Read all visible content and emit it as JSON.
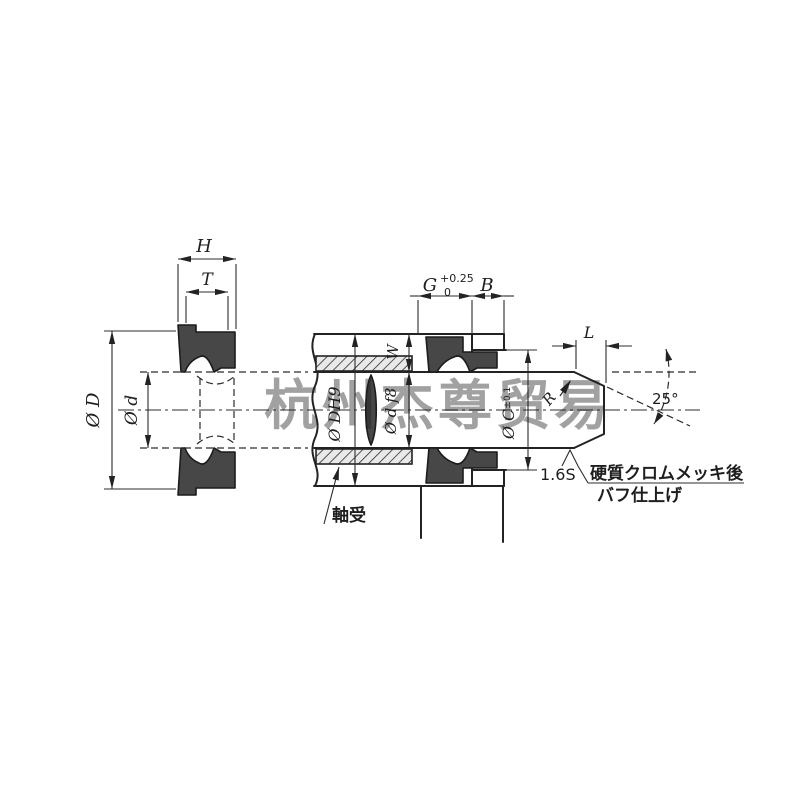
{
  "colors": {
    "background": "#ffffff",
    "line": "#232323",
    "seal_fill": "#474747",
    "watermark": "#bfbfbf"
  },
  "watermark": {
    "text": "杭州杰尊贸易"
  },
  "left_view": {
    "width_label": "H",
    "inner_width_label": "T",
    "outer_dia_label": "Ø D",
    "inner_dia_label": "Ø d"
  },
  "right_view": {
    "groove_width_label": "G",
    "groove_tol_upper": "+0.25",
    "groove_tol_lower": "0",
    "lip_width_label": "B",
    "seal_depth_label": "W",
    "housing_bore_label": "Ø DH9",
    "rod_dia_label": "Ø d f8",
    "lip_bore_label": "Ø C",
    "lip_bore_tol": "±0.1",
    "chamfer_length_label": "L",
    "corner_radius_label": "R",
    "chamfer_angle_label": "25°",
    "surface_finish_label": "1.6S",
    "finish_note_line1": "硬質クロムメッキ後",
    "finish_note_line2": "バフ仕上げ",
    "bearing_label": "軸受"
  }
}
